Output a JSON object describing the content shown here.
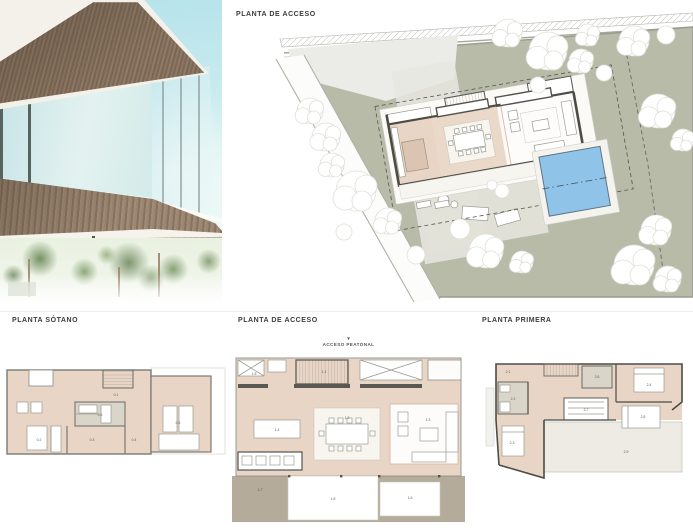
{
  "colors": {
    "label_text": "#3c3c3a",
    "site_green": "#b8bba8",
    "paved": "#ebebe8",
    "paved_light": "#e8e7e2",
    "terrace_gray": "#e3e1d9",
    "pool_blue": "#8fc4e8",
    "wall_dark": "#4c4c46",
    "floor_beige": "#e8d5c5",
    "floor_beige_light": "#f8f5ef",
    "terrace_brown": "#b5ab9a",
    "core_gray": "#d9d5c8",
    "tree_edge": "#e0e0d8",
    "sky_top": "#b5e2ea"
  },
  "sections": {
    "site": {
      "title": "PLANTA DE ACCESO"
    },
    "basement": {
      "title": "PLANTA SÓTANO",
      "labels": [
        {
          "t": "0.1",
          "x": 113,
          "y": 34
        },
        {
          "t": "0.6",
          "x": 97,
          "y": 54
        },
        {
          "t": "0.2",
          "x": 36,
          "y": 79
        },
        {
          "t": "0.3",
          "x": 89,
          "y": 79
        },
        {
          "t": "0.4",
          "x": 131,
          "y": 79
        },
        {
          "t": "0.5",
          "x": 175,
          "y": 62
        }
      ]
    },
    "access": {
      "title": "PLANTA DE ACCESO",
      "pedestrian_access": "ACCESO PEATONAL",
      "arrow": "▼",
      "labels": [
        {
          "t": "1.1",
          "x": 92,
          "y": 37
        },
        {
          "t": "1.5",
          "x": 22,
          "y": 39
        },
        {
          "t": "1.4",
          "x": 45,
          "y": 95
        },
        {
          "t": "1.2",
          "x": 115,
          "y": 83
        },
        {
          "t": "1.3",
          "x": 196,
          "y": 85
        },
        {
          "t": "1.7",
          "x": 28,
          "y": 155
        },
        {
          "t": "1.8",
          "x": 101,
          "y": 164
        },
        {
          "t": "1.6",
          "x": 178,
          "y": 163
        }
      ]
    },
    "first": {
      "title": "PLANTA PRIMERA",
      "labels": [
        {
          "t": "2.1",
          "x": 22,
          "y": 15
        },
        {
          "t": "2.6",
          "x": 111,
          "y": 20
        },
        {
          "t": "2.4",
          "x": 163,
          "y": 28
        },
        {
          "t": "2.2",
          "x": 27,
          "y": 42
        },
        {
          "t": "2.7",
          "x": 100,
          "y": 53
        },
        {
          "t": "2.8",
          "x": 157,
          "y": 60
        },
        {
          "t": "2.3",
          "x": 26,
          "y": 86
        },
        {
          "t": "2.9",
          "x": 140,
          "y": 95
        }
      ]
    }
  },
  "site_plan": {
    "trees": [
      {
        "x": 272,
        "y": 18,
        "r": 14
      },
      {
        "x": 312,
        "y": 36,
        "r": 19
      },
      {
        "x": 352,
        "y": 20,
        "r": 11
      },
      {
        "x": 398,
        "y": 26,
        "r": 15
      },
      {
        "x": 430,
        "y": 20,
        "r": 9
      },
      {
        "x": 368,
        "y": 58,
        "r": 8
      },
      {
        "x": 422,
        "y": 96,
        "r": 17
      },
      {
        "x": 447,
        "y": 125,
        "r": 11
      },
      {
        "x": 420,
        "y": 215,
        "r": 15
      },
      {
        "x": 398,
        "y": 250,
        "r": 20
      },
      {
        "x": 432,
        "y": 264,
        "r": 13
      },
      {
        "x": 250,
        "y": 236,
        "r": 17
      },
      {
        "x": 286,
        "y": 247,
        "r": 11
      },
      {
        "x": 224,
        "y": 214,
        "r": 10
      },
      {
        "x": 120,
        "y": 176,
        "r": 20
      },
      {
        "x": 96,
        "y": 150,
        "r": 12
      },
      {
        "x": 152,
        "y": 206,
        "r": 13
      },
      {
        "x": 108,
        "y": 217,
        "r": 8
      },
      {
        "x": 74,
        "y": 96,
        "r": 13
      },
      {
        "x": 90,
        "y": 122,
        "r": 14
      },
      {
        "x": 345,
        "y": 46,
        "r": 12
      },
      {
        "x": 302,
        "y": 70,
        "r": 8
      },
      {
        "x": 180,
        "y": 240,
        "r": 9
      },
      {
        "x": 266,
        "y": 176,
        "r": 7
      },
      {
        "x": 256,
        "y": 170,
        "r": 5
      }
    ]
  }
}
